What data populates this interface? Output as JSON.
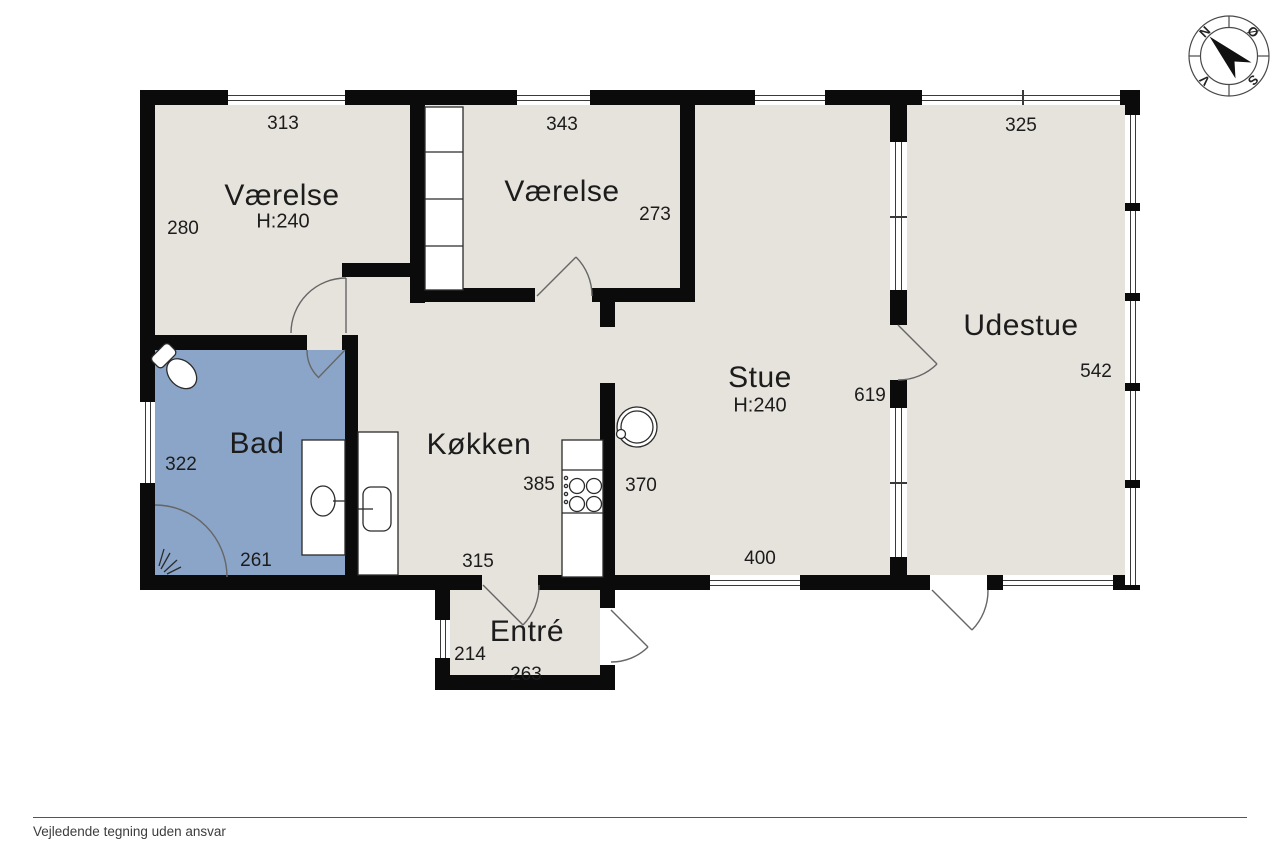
{
  "plan": {
    "rooms": [
      {
        "id": "vaerelse1",
        "name": "Værelse",
        "ceiling": "H:240"
      },
      {
        "id": "vaerelse2",
        "name": "Værelse"
      },
      {
        "id": "udestue",
        "name": "Udestue"
      },
      {
        "id": "stue",
        "name": "Stue",
        "ceiling": "H:240"
      },
      {
        "id": "koekken",
        "name": "Køkken"
      },
      {
        "id": "bad",
        "name": "Bad"
      },
      {
        "id": "entre",
        "name": "Entré"
      }
    ],
    "dims": {
      "d313": "313",
      "d343": "343",
      "d325": "325",
      "d280": "280",
      "d273": "273",
      "d542": "542",
      "d619": "619",
      "d322": "322",
      "d261": "261",
      "d385": "385",
      "d370": "370",
      "d400": "400",
      "d315": "315",
      "d214": "214",
      "d263": "263"
    }
  },
  "compass": {
    "north": "N",
    "east": "Ø",
    "south": "S",
    "west": "V"
  },
  "footer": {
    "disclaimer": "Vejledende tegning uden ansvar"
  },
  "colors": {
    "wall": "#0b0b0b",
    "floor": "#e6e2dc",
    "bath": "#8ba5c8",
    "text": "#1c1c1c",
    "line": "#666666"
  }
}
